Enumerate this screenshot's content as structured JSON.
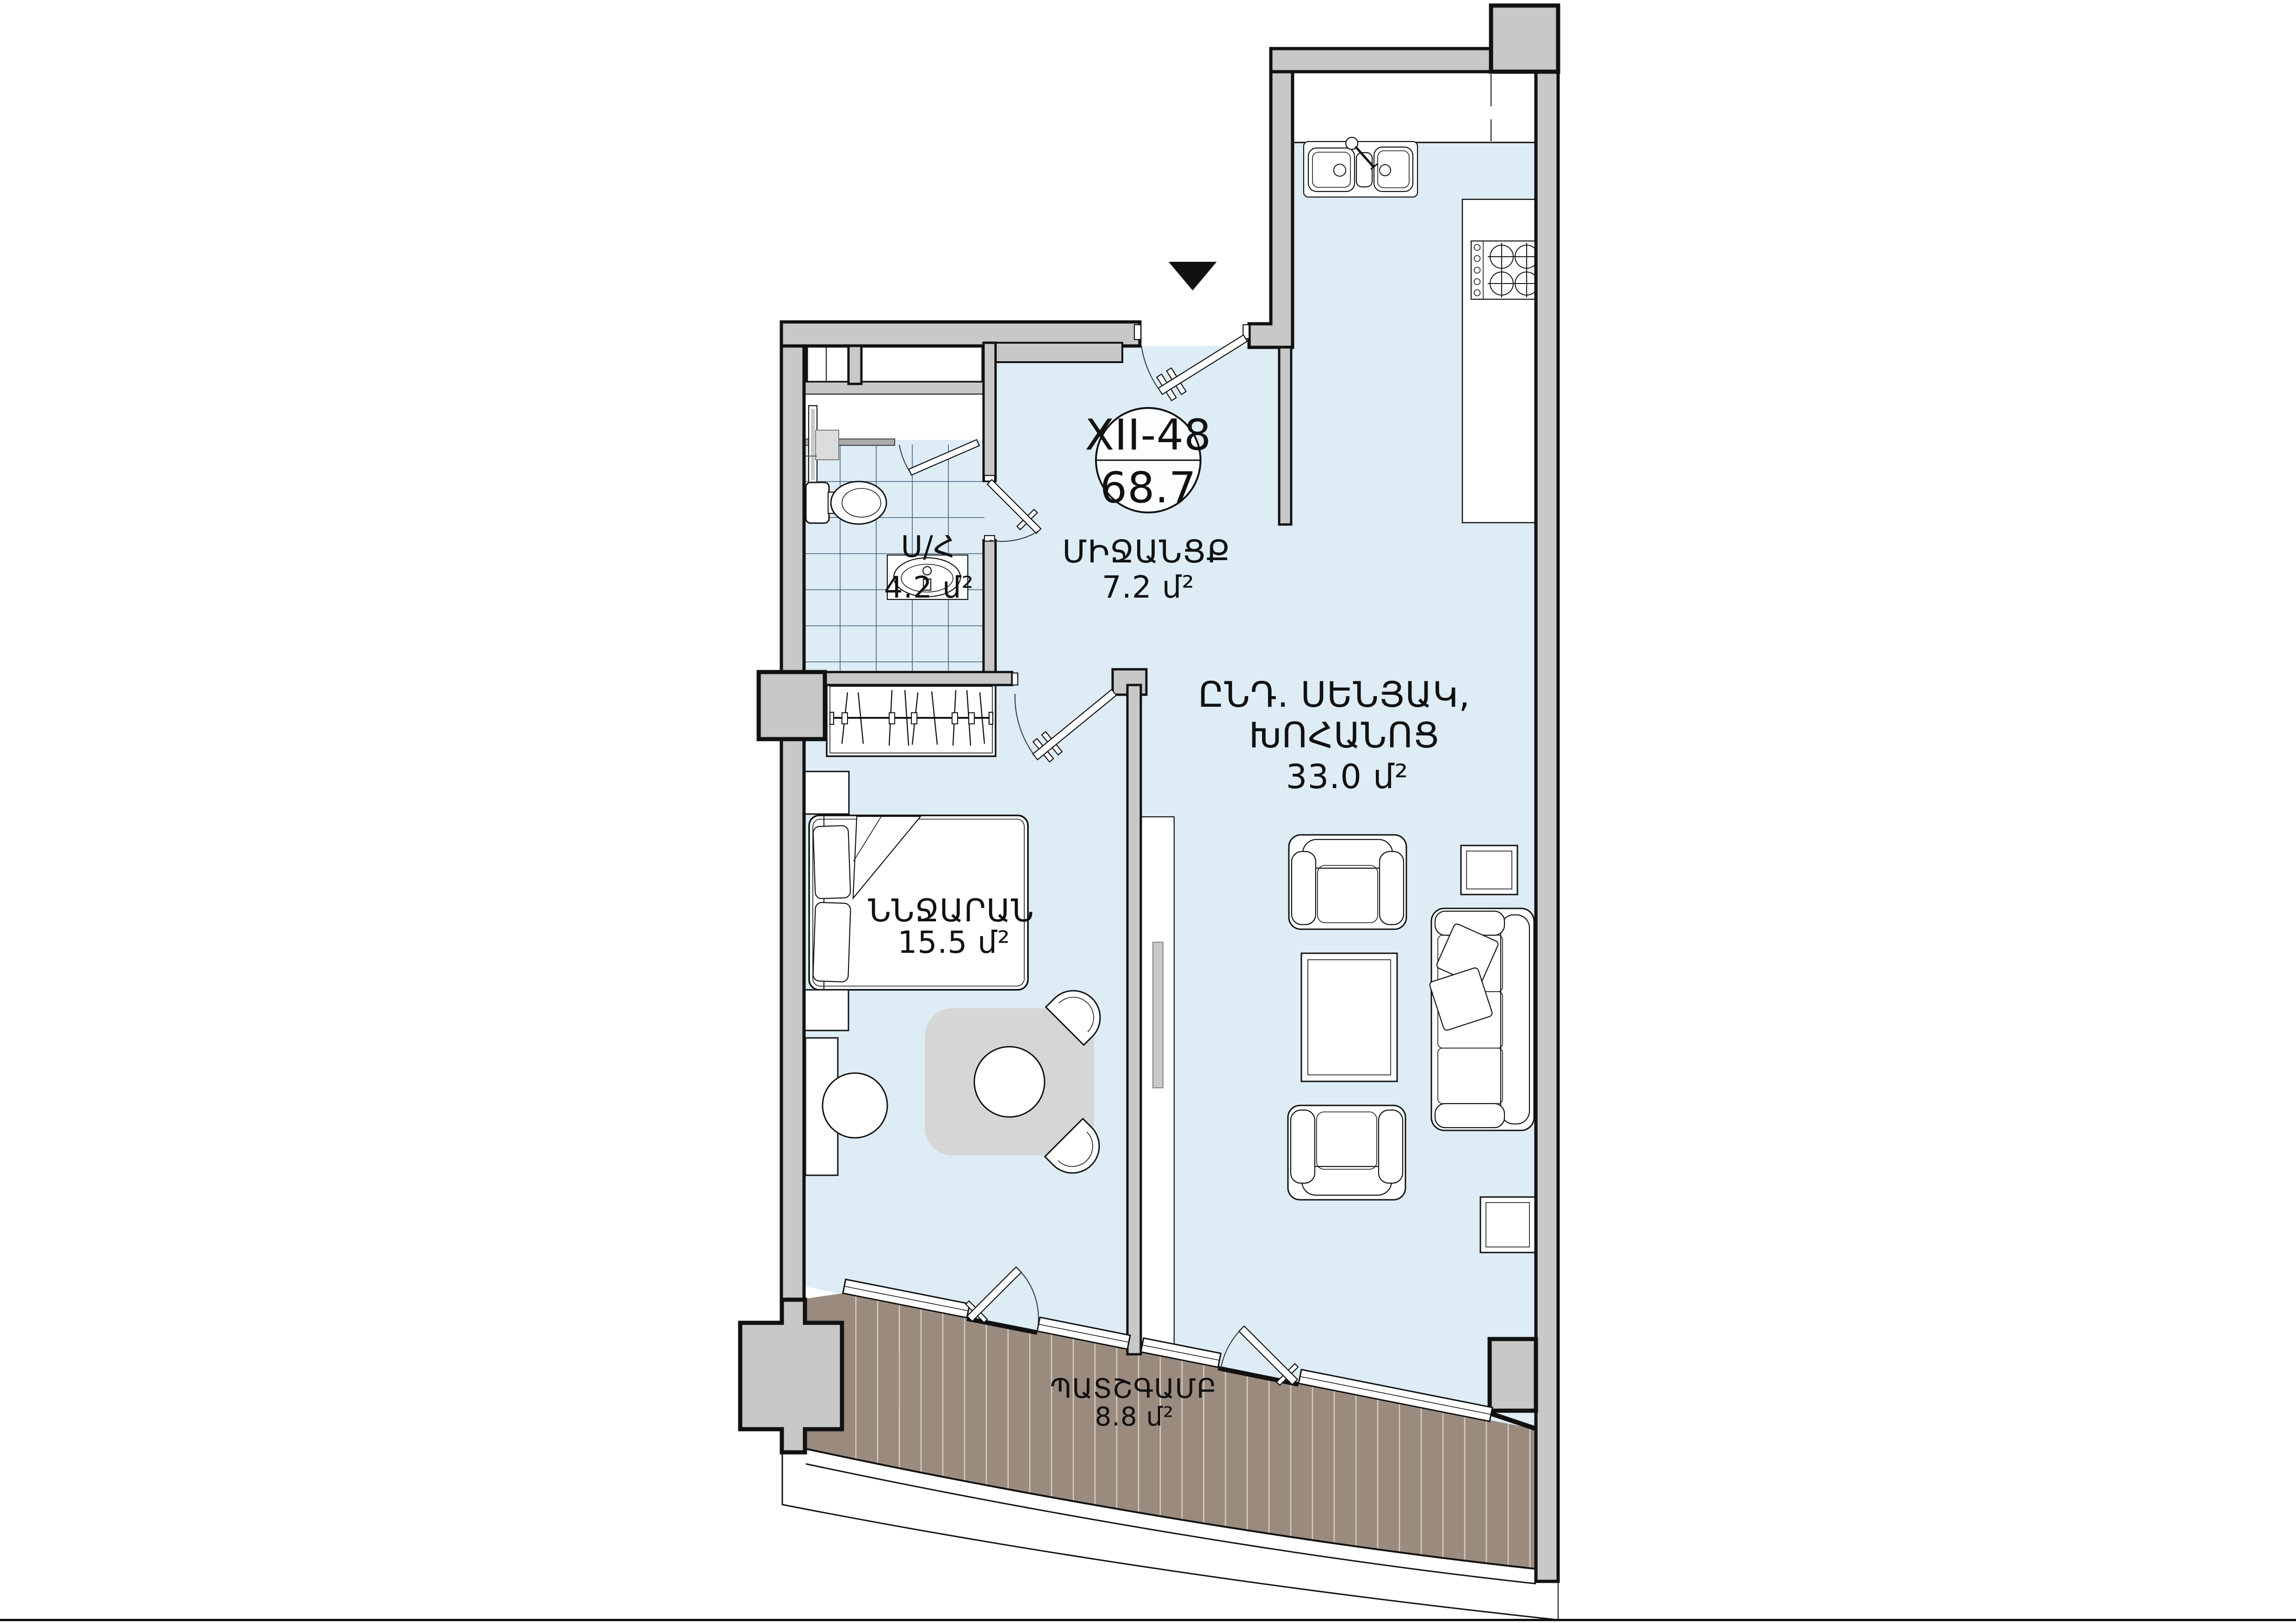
{
  "badge": {
    "unit_number": "XII-48",
    "total_area": "68.7"
  },
  "rooms": {
    "hallway": {
      "name": "ՄԻՋԱՆՑՔ",
      "area": "7.2 մ²"
    },
    "bathroom": {
      "name": "Ս/Հ",
      "area": "4.2 մ²"
    },
    "living_kitchen": {
      "name_line1": "ԸՆԴ. ՍԵՆՅԱԿ,",
      "name_line2": "ԽՈՀԱՆՈՑ",
      "area": "33.0 մ²"
    },
    "bedroom": {
      "name": "ՆՆՋԱՐԱՆ",
      "area": "15.5 մ²"
    },
    "balcony": {
      "name": "ՊԱՏՇԳԱՄԲ",
      "area": "8.8 մ²"
    }
  },
  "colors": {
    "interior_floor": "#ddecf5",
    "wall_fill": "#c8c8c8",
    "outline": "#111111",
    "balcony_deck": "#9b8b7f",
    "rug": "#d6d6d6",
    "badge_fill": "#fcfdfe"
  },
  "icons": {
    "entrance_marker": "down-triangle",
    "fixtures": [
      "kitchen-sink",
      "stove-4-burners",
      "toilet",
      "vanity-sink",
      "shower",
      "towel-rail",
      "wardrobe-hangers",
      "double-bed",
      "sofa",
      "armchair",
      "coffee-table",
      "round-table",
      "tv-console"
    ]
  }
}
